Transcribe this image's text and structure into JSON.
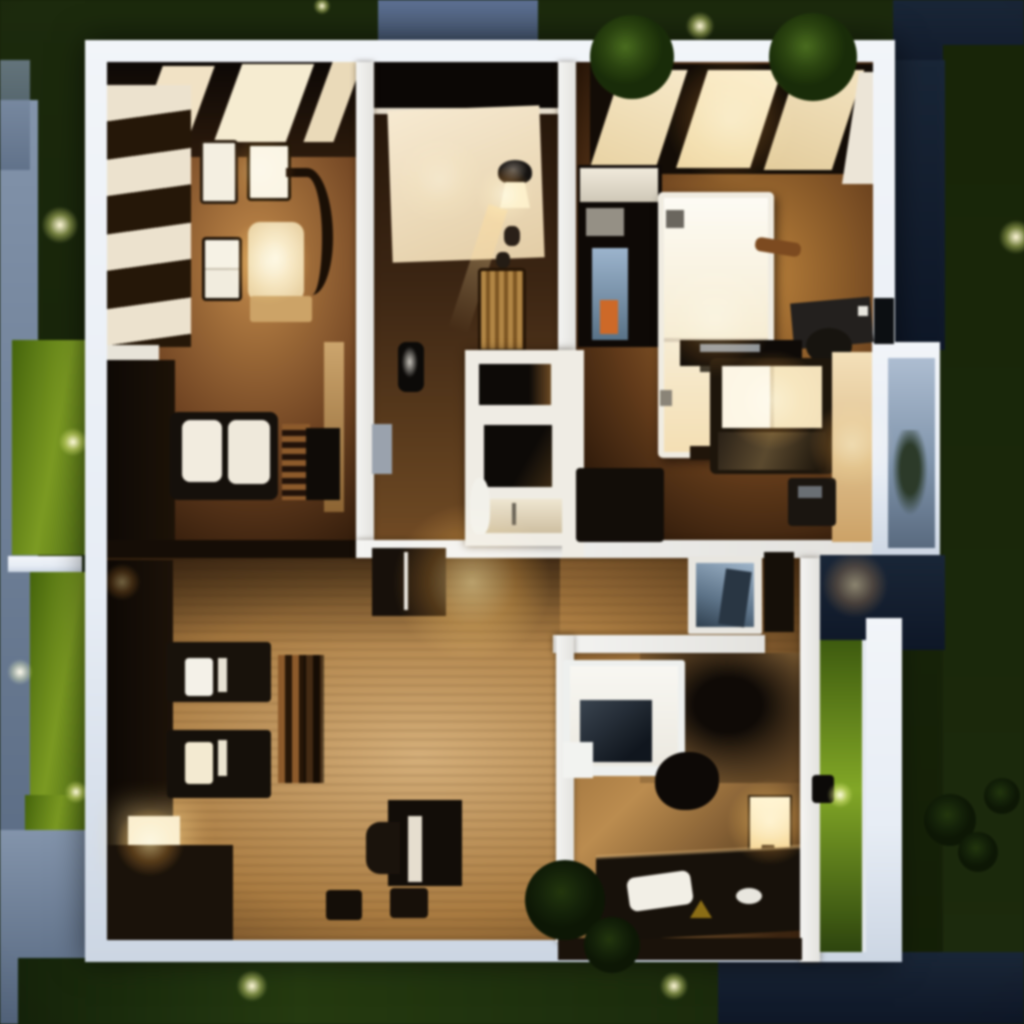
{
  "scene": {
    "description": "Top-down night 3D render of a modern single-storey house floor plan with warm interior lighting, dark lawn, stone paths and glowing garden lights",
    "style": "3d-render-top-down-night",
    "palette": {
      "grass_dark": "#1c2a0e",
      "grass_mid": "#263a12",
      "grass_lime": "#7d9a28",
      "slate_light": "#8494aa",
      "slate_dark": "#55657c",
      "navy_light": "#1a2636",
      "navy_dark": "#0e1726",
      "wall_white": "#e7edf5",
      "floor_tan": "#d2ae7c",
      "floor_brown": "#6e4424",
      "floor_dark": "#241509",
      "lamp_warm": "#ffd9a0",
      "garden_light": "#fff7d8",
      "glass_green": "#83a62c",
      "window_blue": "#aebdd0"
    },
    "rooms": [
      {
        "id": "living-room",
        "label": "living room (top-left)",
        "furniture": [
          "striped wall shelving",
          "wall art panels",
          "curved lounge chair",
          "lit chair cushion",
          "two-pane cabinet",
          "tan bench",
          "ceiling beams"
        ]
      },
      {
        "id": "kitchen-nook",
        "label": "kitchen nook (left-middle)",
        "furniture": [
          "white counter",
          "dark counter run",
          "loveseat with white cushions",
          "slatted coffee table",
          "side table",
          "wall tv"
        ]
      },
      {
        "id": "utility-hall",
        "label": "utility hall (center)",
        "furniture": [
          "wardrobe cream panel",
          "wall sconce",
          "decor vases",
          "wicker hamper",
          "mirror niche",
          "storage niche",
          "sink vanity",
          "toilet figure",
          "grey door"
        ]
      },
      {
        "id": "master-bedroom",
        "label": "master bedroom (top-right)",
        "furniture": [
          "skylight windows",
          "double bed",
          "shelving unit with blue screen and orange box",
          "desk with office chair",
          "media console with lit screen",
          "dark sofa",
          "side table",
          "lit accent wall"
        ]
      },
      {
        "id": "lounge",
        "label": "lounge (bottom-left)",
        "furniture": [
          "dark sideboard",
          "square floor lamp",
          "two armchairs with light cushions",
          "slatted bench",
          "writing desk with chair",
          "two stools",
          "hall cabinet"
        ]
      },
      {
        "id": "small-bedroom",
        "label": "small bedroom (bottom-right)",
        "furniture": [
          "single bed with dark screen panel",
          "bedside lamp",
          "long desk",
          "white papers",
          "mouse",
          "dark chair",
          "wardrobe shadow"
        ]
      },
      {
        "id": "hallway",
        "label": "hallway (right-middle)",
        "furniture": [
          "framed sky picture",
          "dark cabinet"
        ]
      }
    ],
    "exterior": {
      "features": [
        "dark lawn",
        "lime hedge panels",
        "slate stone paths",
        "navy pond / driveway areas",
        "white perimeter wall",
        "round shrubs on wall",
        "green glass patio door",
        "palm silhouette",
        "bay window with plant silhouette"
      ]
    },
    "garden_lights": [
      {
        "x": 60,
        "y": 225,
        "r": 26
      },
      {
        "x": 73,
        "y": 442,
        "r": 20
      },
      {
        "x": 20,
        "y": 672,
        "r": 18
      },
      {
        "x": 76,
        "y": 792,
        "r": 16
      },
      {
        "x": 252,
        "y": 986,
        "r": 22
      },
      {
        "x": 674,
        "y": 986,
        "r": 20
      },
      {
        "x": 700,
        "y": 26,
        "r": 20
      },
      {
        "x": 322,
        "y": 6,
        "r": 12
      },
      {
        "x": 1016,
        "y": 237,
        "r": 24
      },
      {
        "x": 840,
        "y": 795,
        "r": 18
      }
    ],
    "interior_glows": [
      {
        "x": 268,
        "y": 262,
        "r": 60,
        "a": 0.5
      },
      {
        "x": 505,
        "y": 195,
        "r": 40,
        "a": 0.55
      },
      {
        "x": 472,
        "y": 582,
        "r": 110,
        "a": 0.55
      },
      {
        "x": 150,
        "y": 842,
        "r": 48,
        "a": 0.6
      },
      {
        "x": 122,
        "y": 582,
        "r": 26,
        "a": 0.4
      },
      {
        "x": 715,
        "y": 320,
        "r": 80,
        "a": 0.35
      },
      {
        "x": 772,
        "y": 400,
        "r": 70,
        "a": 0.5
      },
      {
        "x": 852,
        "y": 445,
        "r": 60,
        "a": 0.45
      },
      {
        "x": 855,
        "y": 585,
        "r": 46,
        "a": 0.5
      },
      {
        "x": 770,
        "y": 822,
        "r": 60,
        "a": 0.6
      },
      {
        "x": 730,
        "y": 120,
        "r": 90,
        "a": 0.35
      },
      {
        "x": 260,
        "y": 170,
        "r": 50,
        "a": 0.3
      },
      {
        "x": 440,
        "y": 180,
        "r": 60,
        "a": 0.3
      }
    ],
    "bushes": [
      {
        "x": 632,
        "y": 57,
        "r": 42,
        "shade": "green"
      },
      {
        "x": 813,
        "y": 57,
        "r": 44,
        "shade": "green"
      },
      {
        "x": 565,
        "y": 900,
        "r": 40,
        "shade": "dark"
      },
      {
        "x": 612,
        "y": 945,
        "r": 28,
        "shade": "dark"
      },
      {
        "x": 950,
        "y": 820,
        "r": 26,
        "shade": "dark"
      },
      {
        "x": 978,
        "y": 852,
        "r": 20,
        "shade": "dark"
      },
      {
        "x": 1002,
        "y": 796,
        "r": 18,
        "shade": "dark"
      }
    ]
  }
}
